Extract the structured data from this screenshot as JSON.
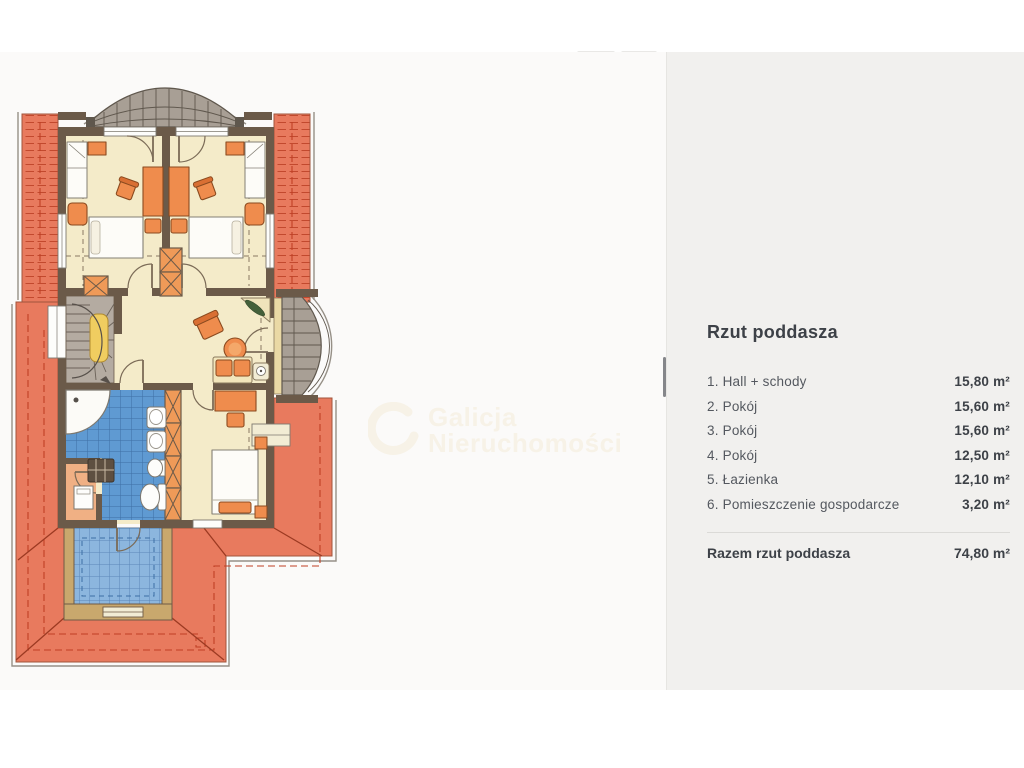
{
  "panel": {
    "title": "Rzut poddasza",
    "rooms": [
      {
        "label": "1. Hall + schody",
        "area": "15,80 m²"
      },
      {
        "label": "2. Pokój",
        "area": "15,60 m²"
      },
      {
        "label": "3. Pokój",
        "area": "15,60 m²"
      },
      {
        "label": "4. Pokój",
        "area": "12,50 m²"
      },
      {
        "label": "5. Łazienka",
        "area": "12,10 m²"
      },
      {
        "label": "6. Pomieszczenie gospodarcze",
        "area": "3,20 m²"
      }
    ],
    "total": {
      "label": "Razem rzut poddasza",
      "area": "74,80 m²"
    }
  },
  "watermark": {
    "line1": "Galicja",
    "line2": "Nieruchomości"
  },
  "plan": {
    "type": "attic-floor-plan",
    "features": [
      "hall-with-winder-stairs",
      "bedroom-top-left",
      "bedroom-top-right",
      "bedroom-bottom-right",
      "bathroom-blue-tiled",
      "utility-room",
      "curved-canopy-top",
      "curved-balcony-right",
      "tiled-balcony-bottom",
      "hipped-roof-surround"
    ],
    "palette": {
      "roof_salmon": "#e87a5e",
      "roof_hatch_red": "#c2492e",
      "wall_brown": "#6b5a49",
      "wood_tan": "#c9a86d",
      "floor_cream": "#f4ebc9",
      "furniture_orange": "#ef8c4d",
      "bath_tile_blue": "#5f9ad2",
      "balcony_tile_blue": "#8cb6de",
      "fan_gray": "#a89f95",
      "stairs_gray": "#b4aba1",
      "landing_yellow": "#f0cd60",
      "panel_bg": "#f1f0ee",
      "text_dark": "#3d4147"
    }
  }
}
